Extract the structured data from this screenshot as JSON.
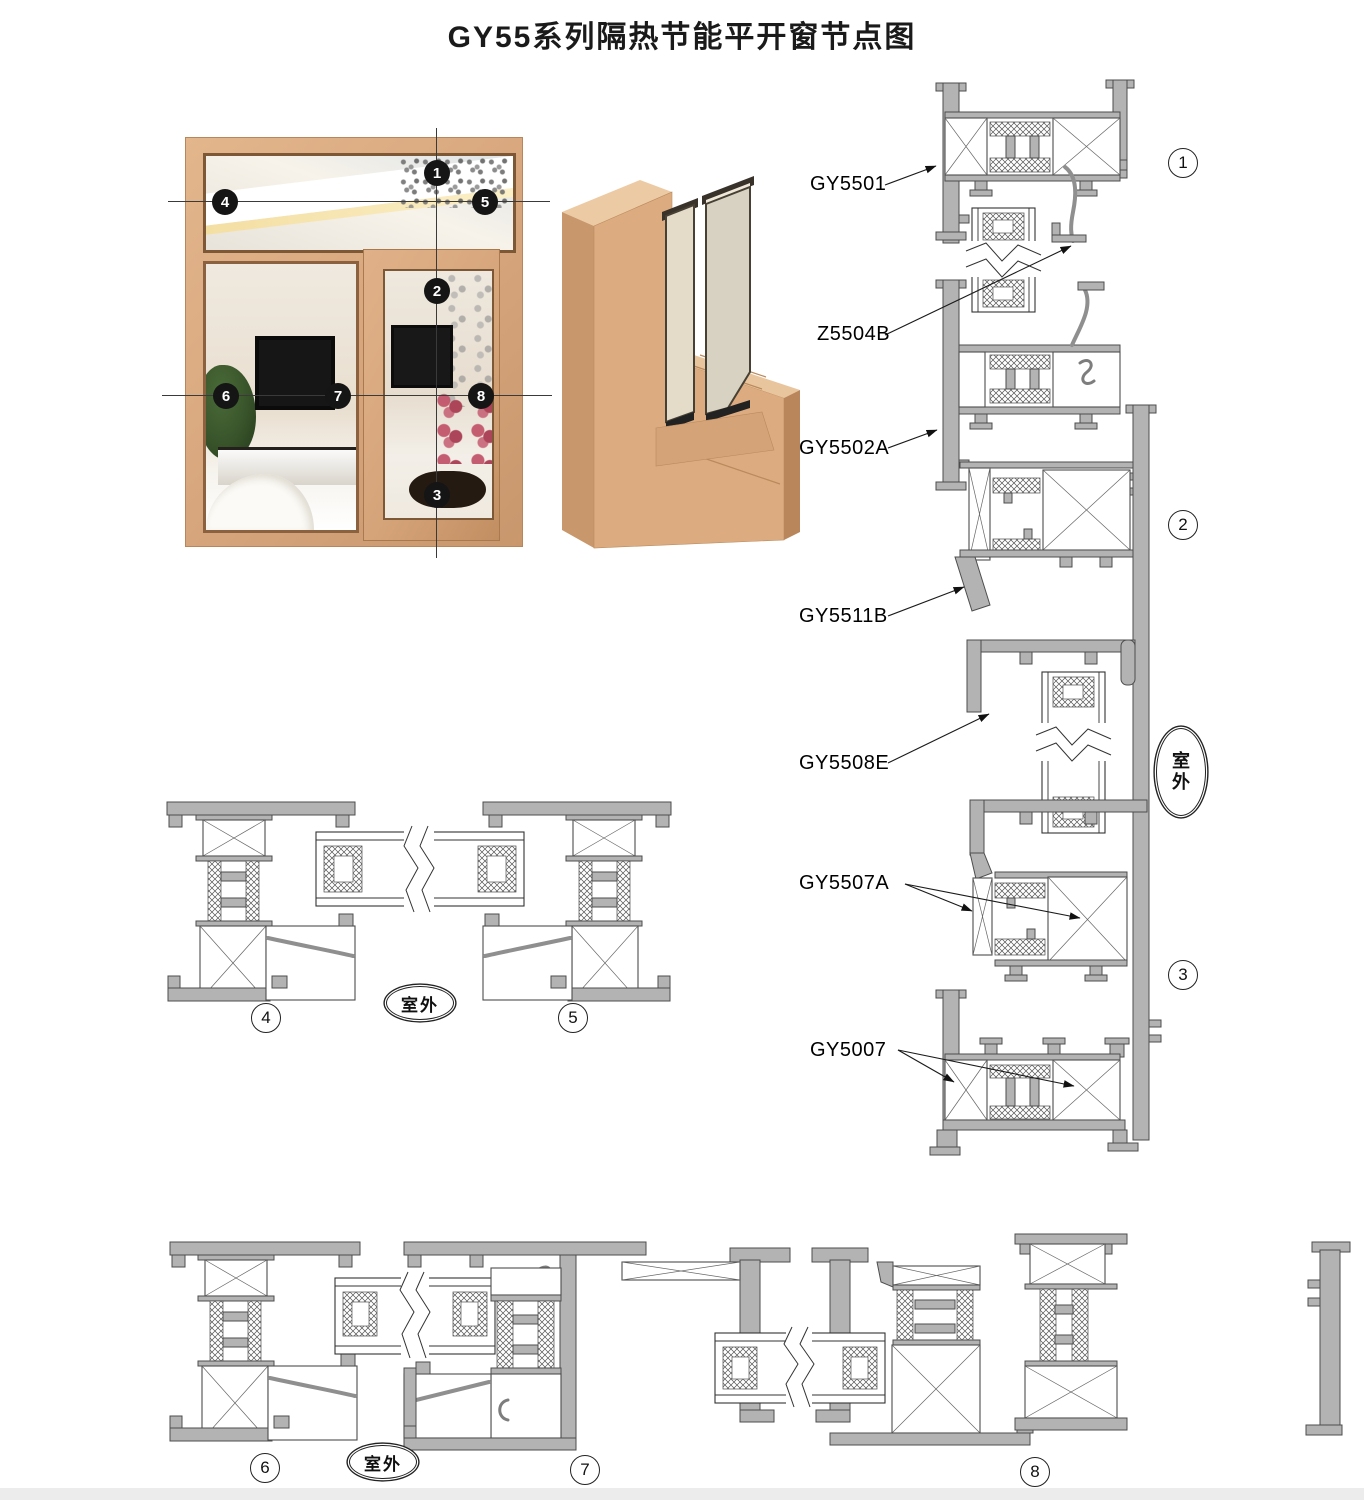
{
  "title": "GY55系列隔热节能平开窗节点图",
  "photo": {
    "markers": [
      "1",
      "2",
      "3",
      "4",
      "5",
      "6",
      "7",
      "8"
    ]
  },
  "parts": {
    "p1": "GY5501",
    "p2": "Z5504B",
    "p3": "GY5502A",
    "p4": "GY5511B",
    "p5": "GY5508E",
    "p6": "GY5507A",
    "p7": "GY5007"
  },
  "sections": {
    "s1": "1",
    "s2": "2",
    "s3": "3",
    "s4": "4",
    "s5": "5",
    "s6": "6",
    "s7": "7",
    "s8": "8"
  },
  "outdoor": {
    "horizontal": "室外",
    "vertical": [
      "室",
      "外"
    ]
  },
  "colors": {
    "frame_tan": "#d9a87f",
    "profile_gray": "#b3b3b3",
    "outline": "#4d4d4d",
    "marker_bg": "#151515"
  }
}
